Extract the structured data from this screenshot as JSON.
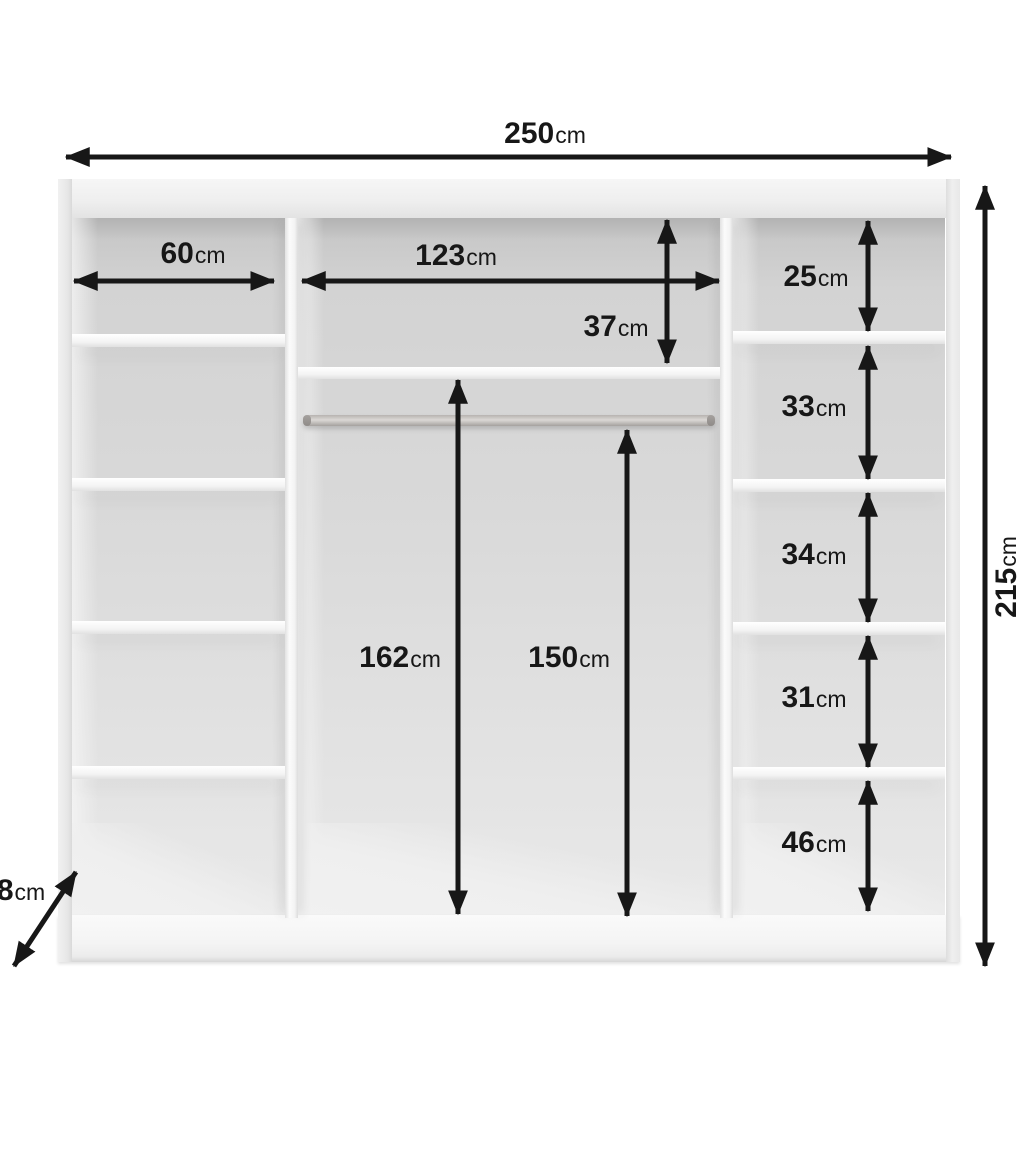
{
  "diagram_title": "wardrobe-interior-dimension-diagram",
  "unit_default": "cm",
  "colors": {
    "annotation": "#171717",
    "background": "#ffffff",
    "back_panel": "#d6d6d6",
    "carcass": "#f2f2f2",
    "rail": "#b3afac"
  },
  "dimensions": {
    "total_width": {
      "value": "250",
      "unit": "cm"
    },
    "total_height": {
      "value": "215",
      "unit": "cm"
    },
    "left_column_width": {
      "value": "60",
      "unit": "cm"
    },
    "middle_column_width": {
      "value": "123",
      "unit": "cm"
    },
    "middle_top_compartment_height": {
      "value": "37",
      "unit": "cm"
    },
    "middle_interior_height": {
      "value": "162",
      "unit": "cm"
    },
    "rail_clearance_height": {
      "value": "150",
      "unit": "cm"
    },
    "right_compartment_1_height": {
      "value": "25",
      "unit": "cm"
    },
    "right_compartment_2_height": {
      "value": "33",
      "unit": "cm"
    },
    "right_compartment_3_height": {
      "value": "34",
      "unit": "cm"
    },
    "right_compartment_4_height": {
      "value": "31",
      "unit": "cm"
    },
    "right_compartment_5_height": {
      "value": "46",
      "unit": "cm"
    },
    "base_height": {
      "value": "8",
      "unit": "cm"
    }
  }
}
